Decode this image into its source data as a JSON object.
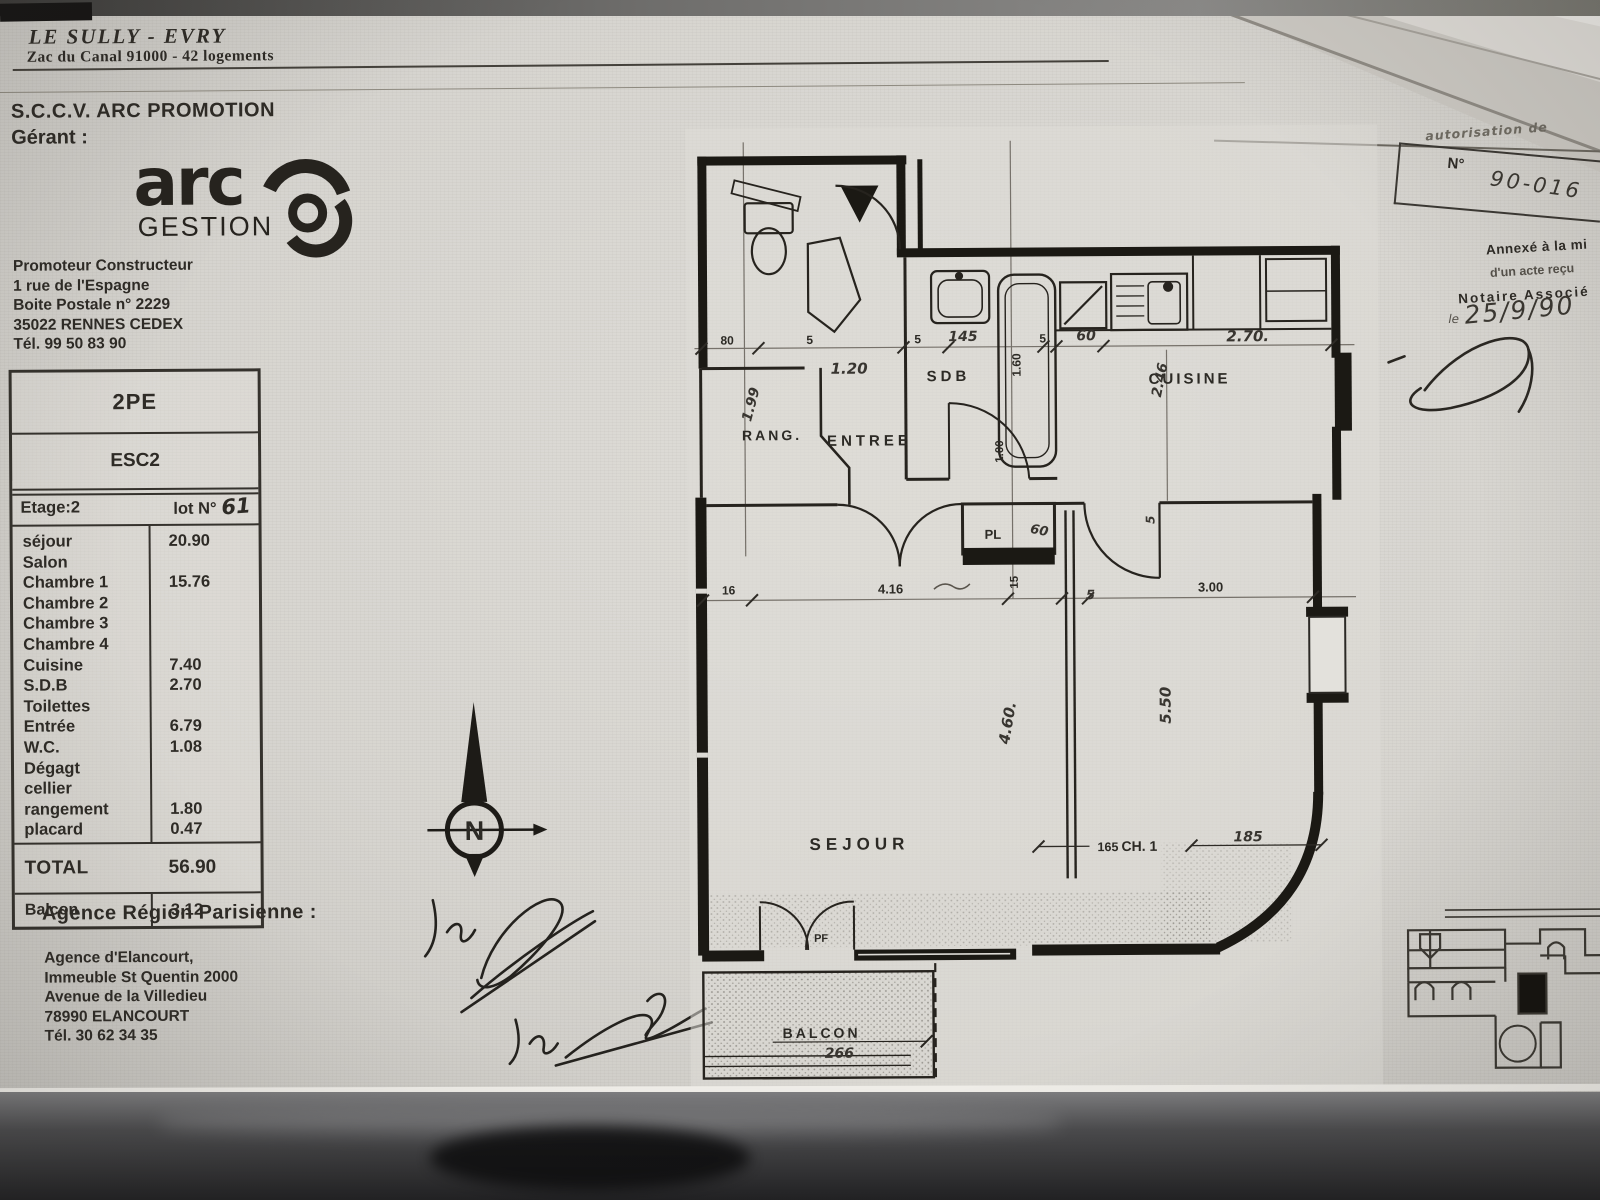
{
  "header": {
    "title": "LE   SULLY - EVRY",
    "subtitle": "Zac du Canal 91000 - 42 logements"
  },
  "promoter": {
    "company": "S.C.C.V. ARC PROMOTION",
    "role_label": "Gérant :",
    "logo_word": "arc",
    "logo_sub": "GESTION",
    "address": "Promoteur Constructeur\n1 rue de l'Espagne\nBoite Postale n° 2229\n35022 RENNES CEDEX\nTél. 99 50 83 90"
  },
  "unit_table": {
    "type_label": "2PE",
    "stair_label": "ESC2",
    "floor_label": "Etage:2",
    "lot_label": "lot N°",
    "lot_number": "61",
    "rows": [
      {
        "label": "séjour",
        "value": "20.90"
      },
      {
        "label": "Salon",
        "value": ""
      },
      {
        "label": "Chambre 1",
        "value": "15.76"
      },
      {
        "label": "Chambre 2",
        "value": ""
      },
      {
        "label": "Chambre 3",
        "value": ""
      },
      {
        "label": "Chambre 4",
        "value": ""
      },
      {
        "label": "Cuisine",
        "value": "7.40"
      },
      {
        "label": "S.D.B",
        "value": "2.70"
      },
      {
        "label": "Toilettes",
        "value": ""
      },
      {
        "label": "Entrée",
        "value": "6.79"
      },
      {
        "label": "W.C.",
        "value": "1.08"
      },
      {
        "label": "Dégagt",
        "value": ""
      },
      {
        "label": "cellier",
        "value": ""
      },
      {
        "label": "rangement",
        "value": "1.80"
      },
      {
        "label": "placard",
        "value": "0.47"
      }
    ],
    "total_label": "TOTAL",
    "total_value": "56.90",
    "balcony_label": "Balcon",
    "balcony_value": "3.12"
  },
  "agency": {
    "title": "Agence Région Parisienne :",
    "address": "Agence d'Elancourt,\nImmeuble St Quentin 2000\nAvenue de la Villedieu\n78990 ELANCOURT\nTél. 30 62 34 35"
  },
  "notary": {
    "top_note": "autorisation de",
    "number_label": "N°",
    "number_value": "90-016",
    "stamp_line1": "Annexé à la mi",
    "stamp_line2": "d'un acte reçu",
    "stamp_line3": "Notaire  Associé",
    "date_prefix": "le",
    "date_value": "25/9/90"
  },
  "signatures": {
    "vu": "Vu"
  },
  "plan": {
    "compass": "N",
    "rooms": {
      "sdb": "SDB",
      "cuisine": "CUISINE",
      "rang": "RANG.",
      "entree": "ENTREE",
      "pl": "PL",
      "sejour": "SEJOUR",
      "ch1": "CH. 1",
      "balcon": "BALCON",
      "pf": "PF"
    },
    "dims": {
      "w80": "80",
      "w5": "5",
      "w120": "1.20",
      "w145": "145",
      "w160": "1.60",
      "w60": "60",
      "w246": "2.46",
      "w270": "2.70.",
      "w199": "1.99",
      "w100": "1.00",
      "w16": "16",
      "w416": "4.16",
      "w15": "15",
      "w300": "3.00",
      "w460": "4.60.",
      "w550": "5.50",
      "w165": "165",
      "w185": "185",
      "w266": "266"
    }
  }
}
